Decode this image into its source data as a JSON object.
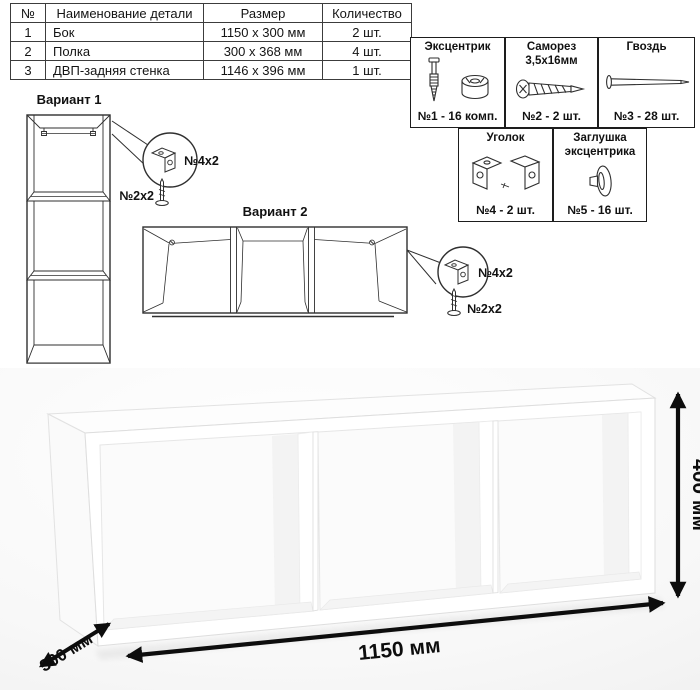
{
  "parts_table": {
    "headers": [
      "№",
      "Наименование детали",
      "Размер",
      "Количество"
    ],
    "rows": [
      {
        "num": "1",
        "name": "Бок",
        "size": "1150 x 300 мм",
        "qty": "2 шт."
      },
      {
        "num": "2",
        "name": "Полка",
        "size": "300 x 368 мм",
        "qty": "4 шт."
      },
      {
        "num": "3",
        "name": "ДВП-задняя стенка",
        "size": "1146 x 396 мм",
        "qty": "1 шт."
      }
    ]
  },
  "hardware": {
    "items": [
      {
        "title": "Эксцентрик",
        "count": "№1 - 16 комп.",
        "icon": "eccentric-cam-icon"
      },
      {
        "title": "Саморез 3,5х16мм",
        "count": "№2 - 2 шт.",
        "icon": "screw-icon"
      },
      {
        "title": "Гвоздь",
        "count": "№3 - 28 шт.",
        "icon": "nail-icon"
      },
      {
        "title": "Уголок",
        "count": "№4 - 2 шт.",
        "icon": "corner-bracket-icon"
      },
      {
        "title": "Заглушка эксцентрика",
        "count": "№5 - 16 шт.",
        "icon": "cam-cap-icon"
      }
    ]
  },
  "variants": {
    "v1": {
      "title": "Вариант 1",
      "bracket_label": "№4х2",
      "screw_label": "№2х2"
    },
    "v2": {
      "title": "Вариант 2",
      "bracket_label": "№4x2",
      "screw_label": "№2x2"
    }
  },
  "dimensions": {
    "width": "1150 мм",
    "height": "400 мм",
    "depth": "300 мм"
  },
  "colors": {
    "line": "#2f2f2f",
    "text": "#0d0d0d",
    "photo_background": "#ebebeb",
    "panel": "#ffffff"
  }
}
